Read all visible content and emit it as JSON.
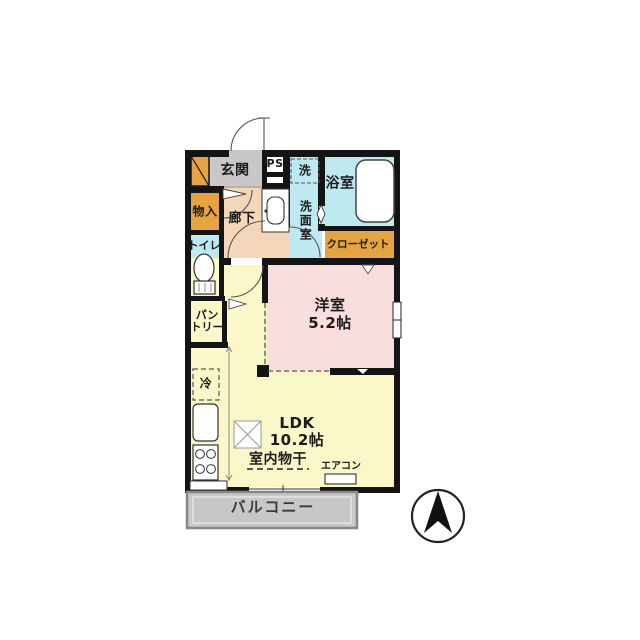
{
  "plan": {
    "rooms": {
      "genkan": {
        "label": "玄関",
        "color": "#c8c8c8"
      },
      "ps": {
        "label": "PS",
        "color": "#ffffff"
      },
      "hallway": {
        "label": "廊下",
        "color": "#f4d7b9"
      },
      "monoiri": {
        "label": "物入",
        "color": "#e5a440"
      },
      "toilet": {
        "label": "トイレ",
        "color": "#bfe9f1"
      },
      "pantry": {
        "label_line1": "パン",
        "label_line2": "トリー",
        "color": "#e5a440"
      },
      "senmenshitsu": {
        "label": "洗面室",
        "color": "#bfe9f1"
      },
      "bathroom": {
        "label": "浴室",
        "color": "#bfe9f1"
      },
      "closet": {
        "label": "クローゼット",
        "color": "#e5a440"
      },
      "youshitsu": {
        "label": "洋室",
        "size": "5.2帖",
        "color": "#f9dede"
      },
      "ldk": {
        "label": "LDK",
        "size": "10.2帖",
        "color": "#faf7c9"
      },
      "balcony": {
        "label": "バルコニー",
        "color": "#c7c7c7"
      }
    },
    "fixtures": {
      "laundry": "洗",
      "fridge": "冷",
      "indoor_drying": "室内物干",
      "aircon": "エアコン"
    },
    "colors": {
      "wall": "#141414",
      "white": "#ffffff"
    }
  }
}
